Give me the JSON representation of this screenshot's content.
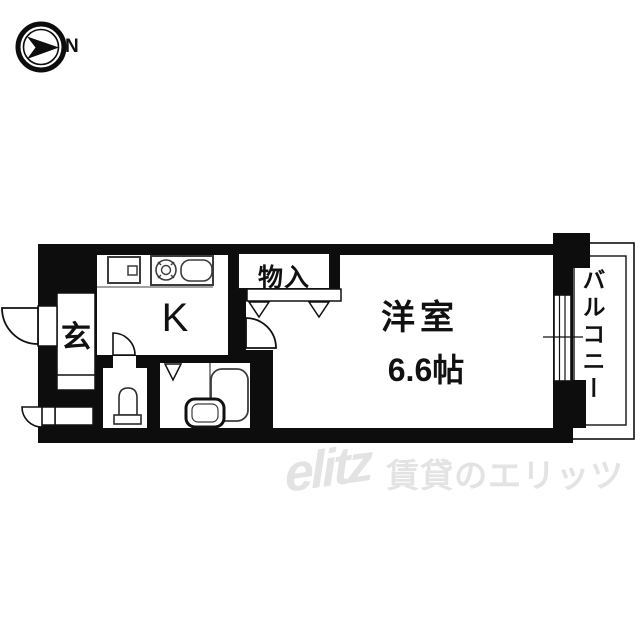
{
  "compass": {
    "north_label": "N"
  },
  "floorplan": {
    "rooms": {
      "entrance": {
        "label": "玄"
      },
      "kitchen": {
        "label": "K"
      },
      "storage": {
        "label": "物入"
      },
      "western_room": {
        "label": "洋室",
        "size": "6.6帖"
      },
      "balcony": {
        "label": "バルコニー"
      }
    },
    "fixtures": [
      "stove-burner",
      "kitchen-sink",
      "kitchen-counter-box",
      "toilet",
      "bathtub",
      "bath-sink"
    ],
    "colors": {
      "wall": "#0d0d0d",
      "line": "#111111",
      "fixture_stroke": "#3c3c3c",
      "background": "#ffffff"
    }
  },
  "watermark": {
    "logo": "elitz",
    "text": "賃貸のエリッツ",
    "color": "#e3e3e3"
  }
}
